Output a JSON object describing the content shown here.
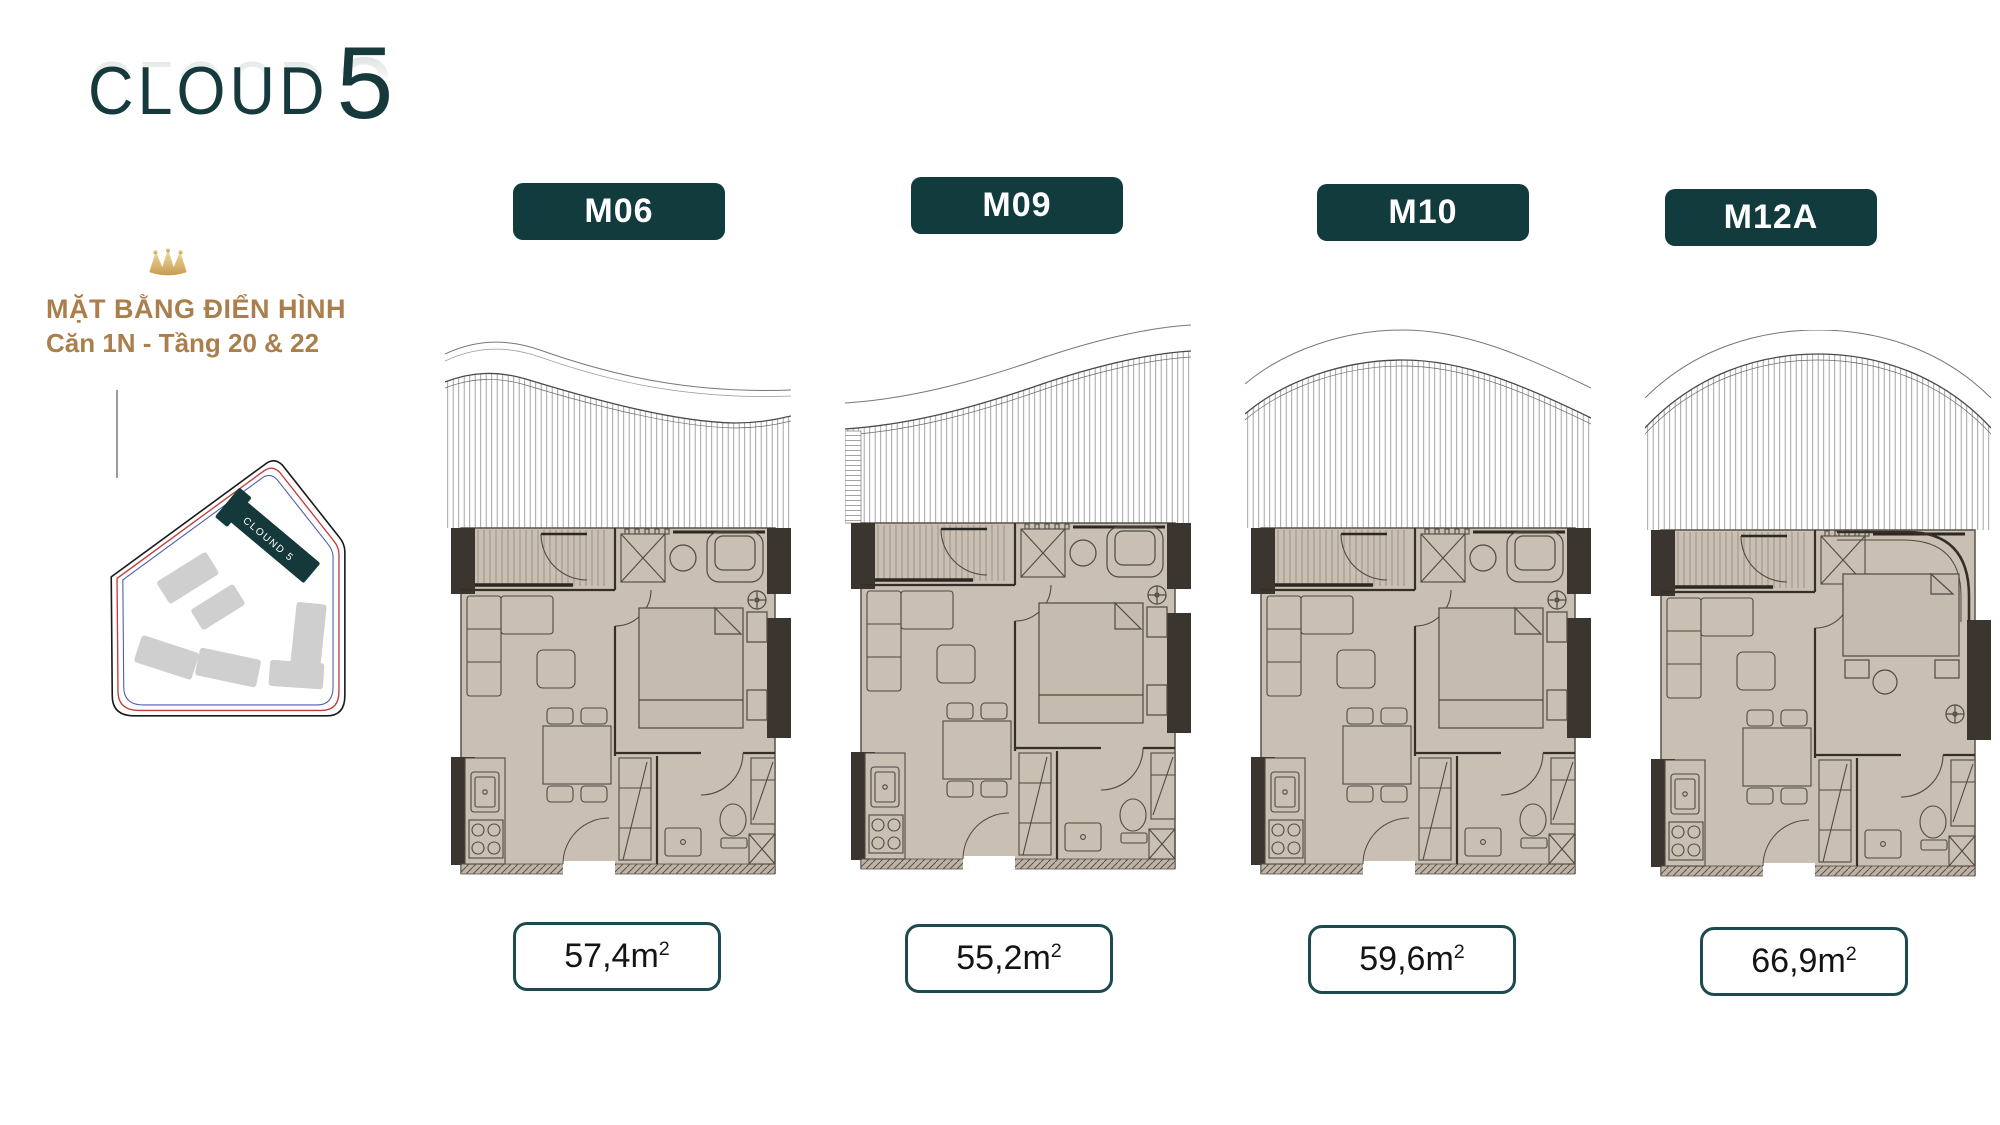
{
  "logo": {
    "brand": "CLOUD",
    "number": "5"
  },
  "header": {
    "title_line1": "MẶT BẰNG ĐIỂN HÌNH",
    "title_line2": "Căn 1N - Tầng 20 & 22"
  },
  "site_plan": {
    "highlight_building_label": "CLOUND 5"
  },
  "units": [
    {
      "code": "M06",
      "area_label": "57,4m",
      "area_sup": "2"
    },
    {
      "code": "M09",
      "area_label": "55,2m",
      "area_sup": "2"
    },
    {
      "code": "M10",
      "area_label": "59,6m",
      "area_sup": "2"
    },
    {
      "code": "M12A",
      "area_label": "66,9m",
      "area_sup": "2"
    }
  ],
  "colors": {
    "accent_teal": "#123B3E",
    "accent_gold": "#AA7F4C",
    "floor_beige": "#C9BFB2",
    "wall_dark": "#3A352E",
    "boundary_red": "#C23B3B",
    "boundary_blue": "#4A5FAE",
    "building_gray": "#CFCFCF"
  }
}
